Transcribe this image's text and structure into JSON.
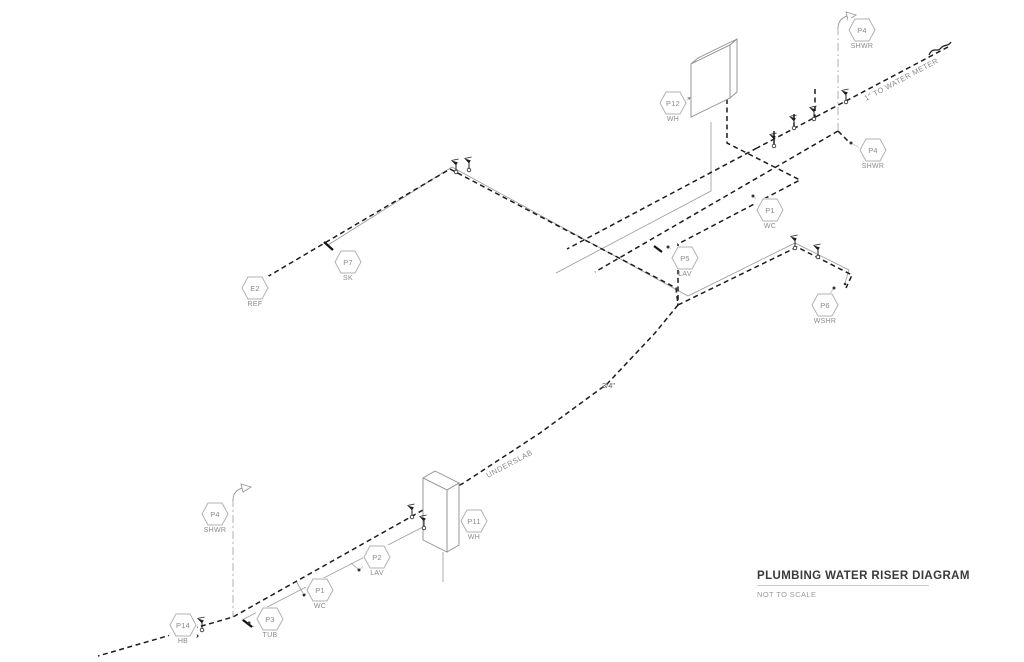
{
  "drawing": {
    "title": "PLUMBING WATER RISER DIAGRAM",
    "scale_note": "NOT TO SCALE"
  },
  "annotations": {
    "water_meter": "1\" TO WATER METER",
    "pipe_size": "3/4\"",
    "underslab": "UNDERSLAB"
  },
  "legend": {
    "dashed_line": "cold water supply",
    "thin_line": "hot water supply",
    "dash_dot_line": "shower riser"
  },
  "colors": {
    "pipe_cold": "#1c1c1c",
    "pipe_hot": "#9a9a9a",
    "riser": "#a8a8a8",
    "tag_outline": "#b2b2b2",
    "tag_text": "#8a8a8a",
    "title_text": "#3a3a3a"
  },
  "tags": [
    {
      "label": "P4",
      "sublabel": "SHWR"
    },
    {
      "label": "P12",
      "sublabel": "WH"
    },
    {
      "label": "P4",
      "sublabel": "SHWR"
    },
    {
      "label": "P1",
      "sublabel": "WC"
    },
    {
      "label": "P7",
      "sublabel": "SK"
    },
    {
      "label": "E2",
      "sublabel": "REF"
    },
    {
      "label": "P5",
      "sublabel": "LAV"
    },
    {
      "label": "P6",
      "sublabel": "WSHR"
    },
    {
      "label": "P4",
      "sublabel": "SHWR"
    },
    {
      "label": "P11",
      "sublabel": "WH"
    },
    {
      "label": "P2",
      "sublabel": "LAV"
    },
    {
      "label": "P1",
      "sublabel": "WC"
    },
    {
      "label": "P3",
      "sublabel": "TUB"
    },
    {
      "label": "P14",
      "sublabel": "HB"
    }
  ]
}
